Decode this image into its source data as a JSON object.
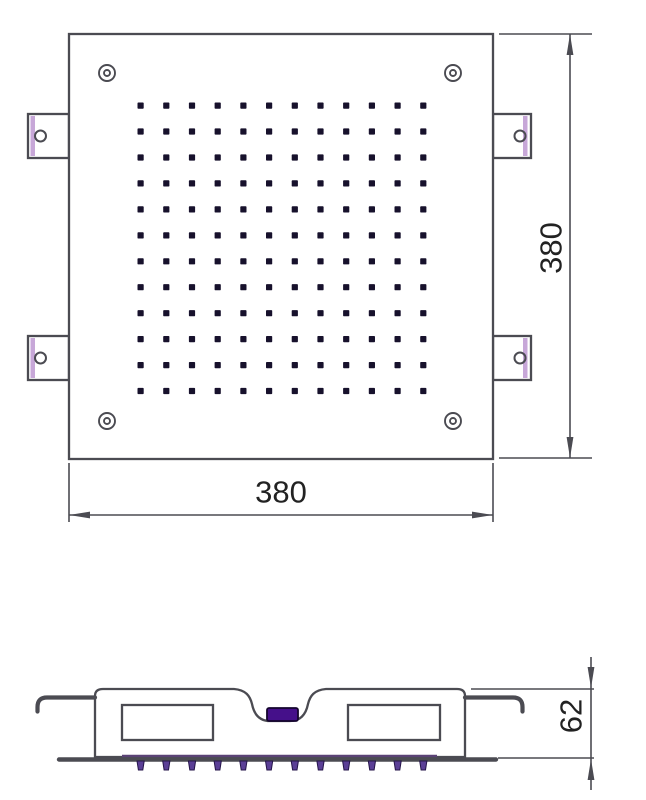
{
  "drawing": {
    "type": "technical-drawing",
    "views": {
      "top_view": "square shower head plate with nozzle grid, corner screws and side mounting tabs",
      "section_view": "side profile with mounting hooks, water chambers, center inlet and nozzle teeth"
    }
  },
  "dimensions": {
    "top_width": "380",
    "top_height": "380",
    "side_height": "62"
  },
  "colors": {
    "line": "#4b4b52",
    "nozzle_dot": "#17112c",
    "tab_stripe": "#c7a7d8",
    "inlet_purple": "#45108a",
    "teeth_purple": "#5b3f96",
    "strip_purple": "#5a4275",
    "text": "#222222"
  },
  "nozzle_grid": {
    "rows": 12,
    "cols": 12,
    "x_start": 140.6,
    "y_start": 105.6,
    "x_step": 25.7,
    "y_step": 25.95,
    "dot_size": 6.2
  },
  "teeth": {
    "count": 12,
    "x_start": 140.6,
    "x_step": 25.7,
    "y_top": 761,
    "y_bottom": 770
  }
}
